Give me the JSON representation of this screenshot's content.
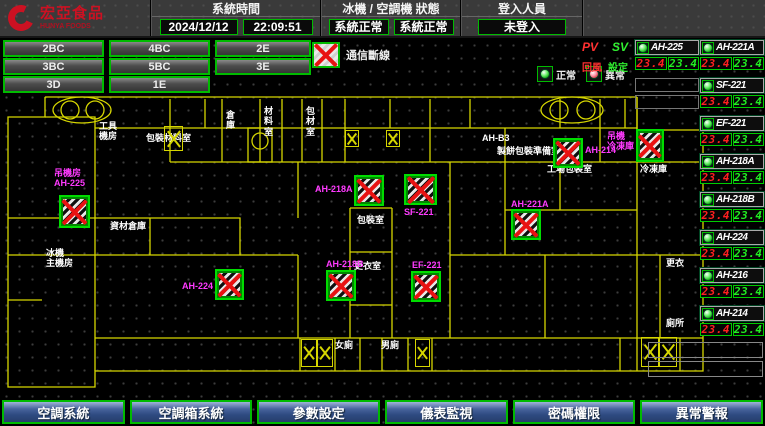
{
  "header": {
    "logo": {
      "name": "宏亞食品",
      "subtitle": "HUNYA FOODS"
    },
    "system_time": {
      "label": "系統時間",
      "date": "2024/12/12",
      "time": "22:09:51"
    },
    "machine_status": {
      "label": "冰機 / 空調機 狀態",
      "chiller": "系統正常",
      "ahu": "系統正常"
    },
    "login": {
      "label": "登入人員",
      "status": "未登入",
      "button": "登入/登出"
    }
  },
  "zone_rows": [
    [
      "2BC",
      "4BC",
      "2E"
    ],
    [
      "3BC",
      "5BC",
      "3E"
    ],
    [
      "3D",
      "1E"
    ]
  ],
  "legend": {
    "comm_fail": "通信斷線",
    "normal": "正常",
    "abnormal": "異常"
  },
  "panel": {
    "pv": "PV",
    "sv": "SV",
    "pv_sub": "回風",
    "sv_sub": "設定",
    "first_unit": {
      "name": "AH-225",
      "pv": "23.4",
      "sv": "23.4"
    },
    "units": [
      {
        "name": "AH-221A",
        "pv": "23.4",
        "sv": "23.4"
      },
      {
        "name": "SF-221",
        "pv": "23.4",
        "sv": "23.4"
      },
      {
        "name": "EF-221",
        "pv": "23.4",
        "sv": "23.4"
      },
      {
        "name": "AH-218A",
        "pv": "23.4",
        "sv": "23.4"
      },
      {
        "name": "AH-218B",
        "pv": "23.4",
        "sv": "23.4"
      },
      {
        "name": "AH-224",
        "pv": "23.4",
        "sv": "23.4"
      },
      {
        "name": "AH-216",
        "pv": "23.4",
        "sv": "23.4"
      },
      {
        "name": "AH-214",
        "pv": "23.4",
        "sv": "23.4"
      }
    ]
  },
  "nav_buttons": [
    "空調系統",
    "空調箱系統",
    "參數設定",
    "儀表監視",
    "密碼權限",
    "異常警報"
  ],
  "map": {
    "rooms": [
      {
        "x": 99,
        "y": 121,
        "text": "工具\n機房"
      },
      {
        "x": 146,
        "y": 133,
        "text": "包裝材料室"
      },
      {
        "x": 226,
        "y": 110,
        "text": "倉\n庫"
      },
      {
        "x": 264,
        "y": 106,
        "text": "材\n料\n室"
      },
      {
        "x": 306,
        "y": 106,
        "text": "包\n材\n室"
      },
      {
        "x": 482,
        "y": 133,
        "text": "AH-B3"
      },
      {
        "x": 497,
        "y": 146,
        "text": "製餅包裝準備室"
      },
      {
        "x": 547,
        "y": 164,
        "text": "工場包裝室"
      },
      {
        "x": 640,
        "y": 164,
        "text": "冷凍庫"
      },
      {
        "x": 357,
        "y": 215,
        "text": "包裝室"
      },
      {
        "x": 354,
        "y": 261,
        "text": "更衣室"
      },
      {
        "x": 46,
        "y": 248,
        "text": "冰機\n主機房"
      },
      {
        "x": 110,
        "y": 221,
        "text": "資材倉庫"
      },
      {
        "x": 335,
        "y": 340,
        "text": "女廁"
      },
      {
        "x": 381,
        "y": 340,
        "text": "男廁"
      },
      {
        "x": 666,
        "y": 258,
        "text": "更衣"
      },
      {
        "x": 666,
        "y": 318,
        "text": "廁所"
      }
    ],
    "equipment": [
      {
        "x": 59,
        "y": 195,
        "w": 31,
        "h": 33,
        "label": "吊機房\nAH-225",
        "lx": 54,
        "ly": 168
      },
      {
        "x": 215,
        "y": 269,
        "w": 29,
        "h": 31,
        "label": "AH-224",
        "lx": 182,
        "ly": 281
      },
      {
        "x": 354,
        "y": 175,
        "w": 30,
        "h": 31,
        "label": "AH-218A",
        "lx": 315,
        "ly": 184
      },
      {
        "x": 404,
        "y": 174,
        "w": 33,
        "h": 31,
        "label": "SF-221",
        "lx": 404,
        "ly": 207
      },
      {
        "x": 326,
        "y": 270,
        "w": 30,
        "h": 31,
        "label": "AH-218B",
        "lx": 326,
        "ly": 259
      },
      {
        "x": 411,
        "y": 271,
        "w": 30,
        "h": 31,
        "label": "EF-221",
        "lx": 412,
        "ly": 260
      },
      {
        "x": 511,
        "y": 209,
        "w": 30,
        "h": 31,
        "label": "AH-221A",
        "lx": 511,
        "ly": 199
      },
      {
        "x": 553,
        "y": 138,
        "w": 30,
        "h": 30,
        "label": "AH-214",
        "lx": 585,
        "ly": 145
      },
      {
        "x": 636,
        "y": 129,
        "w": 28,
        "h": 33,
        "label": "吊機\n冷凍庫",
        "lx": 607,
        "ly": 131
      }
    ],
    "stairs": [
      {
        "x": 164,
        "y": 126,
        "w": 19,
        "h": 25
      },
      {
        "x": 345,
        "y": 130,
        "w": 14,
        "h": 17
      },
      {
        "x": 386,
        "y": 130,
        "w": 14,
        "h": 17
      },
      {
        "x": 301,
        "y": 339,
        "w": 16,
        "h": 28
      },
      {
        "x": 317,
        "y": 339,
        "w": 16,
        "h": 28
      },
      {
        "x": 415,
        "y": 339,
        "w": 15,
        "h": 28
      },
      {
        "x": 641,
        "y": 337,
        "w": 18,
        "h": 30
      },
      {
        "x": 659,
        "y": 337,
        "w": 18,
        "h": 30
      }
    ]
  },
  "colors": {
    "accent_green": "#00bb00",
    "alarm_red": "#e81212",
    "magenta": "#ff3aff",
    "wall_yellow": "#d6d600",
    "nav_blue": "#2e4a80",
    "pv_red": "#ff2020",
    "sv_green": "#22ee22"
  }
}
